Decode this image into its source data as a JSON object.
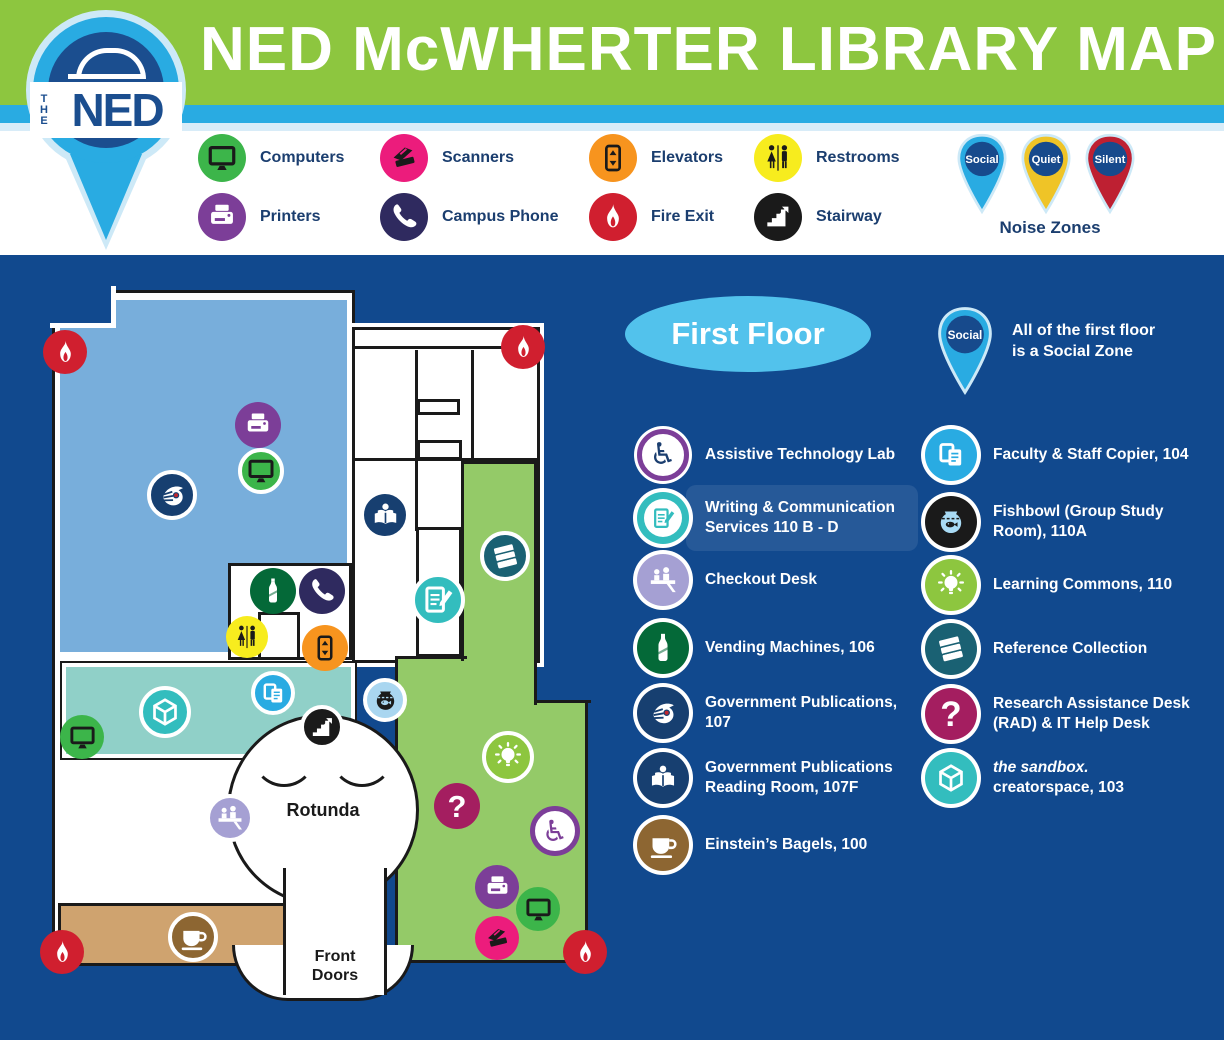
{
  "header": {
    "title": "NED McWHERTER LIBRARY MAP",
    "logo": {
      "the": "THE",
      "ned": "NED"
    }
  },
  "legend": {
    "items": [
      {
        "icon": "computer-icon",
        "label": "Computers",
        "bg": "#3CB54A",
        "fg": "#1A1A1A",
        "col": 0,
        "row": 0
      },
      {
        "icon": "printer-icon",
        "label": "Printers",
        "bg": "#7C3E98",
        "fg": "#FFFFFF",
        "col": 0,
        "row": 1
      },
      {
        "icon": "scanner-icon",
        "label": "Scanners",
        "bg": "#EC1C7C",
        "fg": "#1A1A1A",
        "col": 1,
        "row": 0
      },
      {
        "icon": "phone-icon",
        "label": "Campus Phone",
        "bg": "#2F2A5F",
        "fg": "#FFFFFF",
        "col": 1,
        "row": 1
      },
      {
        "icon": "elevator-icon",
        "label": "Elevators",
        "bg": "#F7941E",
        "fg": "#1A1A1A",
        "col": 2,
        "row": 0
      },
      {
        "icon": "flame-icon",
        "label": "Fire Exit",
        "bg": "#D01F2F",
        "fg": "#FFFFFF",
        "col": 2,
        "row": 1
      },
      {
        "icon": "restrooms-icon",
        "label": "Restrooms",
        "bg": "#F7EC1E",
        "fg": "#1A1A1A",
        "col": 3,
        "row": 0
      },
      {
        "icon": "stairs-icon",
        "label": "Stairway",
        "bg": "#1A1A1A",
        "fg": "#FFFFFF",
        "col": 3,
        "row": 1
      }
    ],
    "noise_zones": {
      "label": "Noise Zones",
      "pins": [
        {
          "label": "Social",
          "color": "#29ABE2"
        },
        {
          "label": "Quiet",
          "color": "#EFC427"
        },
        {
          "label": "Silent",
          "color": "#BE2032"
        }
      ]
    }
  },
  "map": {
    "floor_label": "First Floor",
    "zone_note": {
      "pin_label": "Social",
      "pin_color": "#29ABE2",
      "line1": "All of the first floor",
      "line2": "is a Social Zone"
    },
    "rotunda_label": "Rotunda",
    "front_doors": {
      "line1": "Front",
      "line2": "Doors"
    },
    "region_colors": {
      "government_publications": "#78AEDB",
      "sandbox": "#90D0C8",
      "learning_commons": "#94CA68",
      "einsteins": "#CFA36F",
      "background": "#11498E"
    },
    "markers": [
      {
        "icon": "flame-icon",
        "x": 65,
        "y": 97,
        "d": 44,
        "bg": "#D01F2F",
        "fg": "#FFFFFF"
      },
      {
        "icon": "flame-icon",
        "x": 523,
        "y": 92,
        "d": 44,
        "bg": "#D01F2F",
        "fg": "#FFFFFF"
      },
      {
        "icon": "flame-icon",
        "x": 62,
        "y": 697,
        "d": 44,
        "bg": "#D01F2F",
        "fg": "#FFFFFF"
      },
      {
        "icon": "flame-icon",
        "x": 585,
        "y": 697,
        "d": 44,
        "bg": "#D01F2F",
        "fg": "#FFFFFF"
      },
      {
        "icon": "printer-icon",
        "x": 258,
        "y": 170,
        "d": 46,
        "bg": "#7C3E98",
        "fg": "#FFFFFF"
      },
      {
        "icon": "computer-icon",
        "x": 261,
        "y": 216,
        "d": 46,
        "bg": "#3CB54A",
        "fg": "#1A1A1A",
        "ring": true
      },
      {
        "icon": "eagle-icon",
        "x": 172,
        "y": 240,
        "d": 50,
        "bg": "#173F70",
        "fg": "#FFFFFF",
        "ring": true
      },
      {
        "icon": "reading-icon",
        "x": 385,
        "y": 260,
        "d": 50,
        "bg": "#173F70",
        "fg": "#FFFFFF",
        "ring": true
      },
      {
        "icon": "books-icon",
        "x": 505,
        "y": 301,
        "d": 50,
        "bg": "#1A6173",
        "fg": "#FFFFFF",
        "ring": true
      },
      {
        "icon": "pencil-icon",
        "x": 438,
        "y": 345,
        "d": 54,
        "bg": "#33BDBE",
        "fg": "#FFFFFF",
        "ring": true
      },
      {
        "icon": "bottle-icon",
        "x": 273,
        "y": 336,
        "d": 46,
        "bg": "#046938",
        "fg": "#FFFFFF"
      },
      {
        "icon": "phone-icon",
        "x": 322,
        "y": 336,
        "d": 46,
        "bg": "#2F2A5F",
        "fg": "#FFFFFF"
      },
      {
        "icon": "restrooms-icon",
        "x": 247,
        "y": 382,
        "d": 42,
        "bg": "#F7EC1E",
        "fg": "#1A1A1A"
      },
      {
        "icon": "elevator-icon",
        "x": 325,
        "y": 393,
        "d": 46,
        "bg": "#F7941E",
        "fg": "#1A1A1A"
      },
      {
        "icon": "copier-icon",
        "x": 273,
        "y": 438,
        "d": 44,
        "bg": "#29ABE2",
        "fg": "#FFFFFF",
        "ring": true
      },
      {
        "icon": "fishbowl-icon",
        "x": 385,
        "y": 445,
        "d": 44,
        "bg": "#A9D6F0",
        "fg": "#1A1A1A",
        "inner": "#A9D6F0",
        "ring": true
      },
      {
        "icon": "cube-icon",
        "x": 165,
        "y": 457,
        "d": 52,
        "bg": "#33BDBE",
        "fg": "#FFFFFF",
        "ring": true
      },
      {
        "icon": "stairs-icon",
        "x": 322,
        "y": 472,
        "d": 44,
        "bg": "#1A1A1A",
        "fg": "#FFFFFF",
        "ring": true
      },
      {
        "icon": "computer-icon",
        "x": 82,
        "y": 482,
        "d": 44,
        "bg": "#3CB54A",
        "fg": "#1A1A1A"
      },
      {
        "icon": "bulb-icon",
        "x": 508,
        "y": 502,
        "d": 52,
        "bg": "#8DC63F",
        "fg": "#FFFFFF",
        "ring": true
      },
      {
        "icon": "question-icon",
        "x": 457,
        "y": 551,
        "d": 46,
        "bg": "#A41E60",
        "fg": "#FFFFFF"
      },
      {
        "icon": "desk-icon",
        "x": 230,
        "y": 563,
        "d": 48,
        "bg": "#A5A0D3",
        "fg": "#FFFFFF",
        "ring": true
      },
      {
        "icon": "wheelchair-icon",
        "x": 555,
        "y": 576,
        "d": 50,
        "bg": "#FFFFFF",
        "fg": "#7C3E98",
        "style": "assistive"
      },
      {
        "icon": "printer-icon",
        "x": 497,
        "y": 632,
        "d": 44,
        "bg": "#7C3E98",
        "fg": "#FFFFFF"
      },
      {
        "icon": "computer-icon",
        "x": 538,
        "y": 654,
        "d": 44,
        "bg": "#3CB54A",
        "fg": "#1A1A1A"
      },
      {
        "icon": "scanner-icon",
        "x": 497,
        "y": 683,
        "d": 44,
        "bg": "#EC1C7C",
        "fg": "#1A1A1A"
      },
      {
        "icon": "coffee-icon",
        "x": 193,
        "y": 682,
        "d": 50,
        "bg": "#8D6632",
        "fg": "#FFFFFF",
        "ring": true
      }
    ]
  },
  "key": {
    "column1": [
      {
        "icon": "wheelchair-icon",
        "label": "Assistive Technology Lab",
        "bg": "#FFFFFF",
        "fg": "#1B3E6F",
        "style": "assistive"
      },
      {
        "icon": "pencil-icon",
        "label": "Writing & Communication Services 110 B - D",
        "bg": "#33BDBE",
        "fg": "#33BDBE",
        "style": "writing",
        "highlight": true
      },
      {
        "icon": "desk-icon",
        "label": "Checkout Desk",
        "bg": "#A5A0D3",
        "fg": "#FFFFFF"
      },
      {
        "icon": "bottle-icon",
        "label": "Vending Machines, 106",
        "bg": "#046938",
        "fg": "#FFFFFF"
      },
      {
        "icon": "eagle-icon",
        "label": "Government Publications, 107",
        "bg": "#173F70",
        "fg": "#FFFFFF"
      },
      {
        "icon": "reading-icon",
        "label": "Government Publications Reading Room, 107F",
        "bg": "#173F70",
        "fg": "#FFFFFF"
      },
      {
        "icon": "coffee-icon",
        "label": "Einstein’s Bagels, 100",
        "bg": "#8D6632",
        "fg": "#FFFFFF"
      }
    ],
    "column2": [
      {
        "icon": "copier-icon",
        "label": "Faculty & Staff Copier, 104",
        "bg": "#29ABE2",
        "fg": "#FFFFFF"
      },
      {
        "icon": "fishbowl-icon",
        "label": "Fishbowl (Group Study Room), 110A",
        "bg": "#1A1A1A",
        "fg": "#A9DBF5",
        "inner": "#1A1A1A"
      },
      {
        "icon": "bulb-icon",
        "label": "Learning Commons, 110",
        "bg": "#8DC63F",
        "fg": "#FFFFFF"
      },
      {
        "icon": "books-icon",
        "label": "Reference Collection",
        "bg": "#1A6173",
        "fg": "#FFFFFF"
      },
      {
        "icon": "question-icon",
        "label": "Research Assistance Desk (RAD) & IT Help Desk",
        "bg": "#A41E60",
        "fg": "#FFFFFF"
      },
      {
        "icon": "cube-icon",
        "label_italic": "the sandbox.",
        "label": "creatorspace, 103",
        "bg": "#33BDBE",
        "fg": "#FFFFFF"
      }
    ]
  }
}
